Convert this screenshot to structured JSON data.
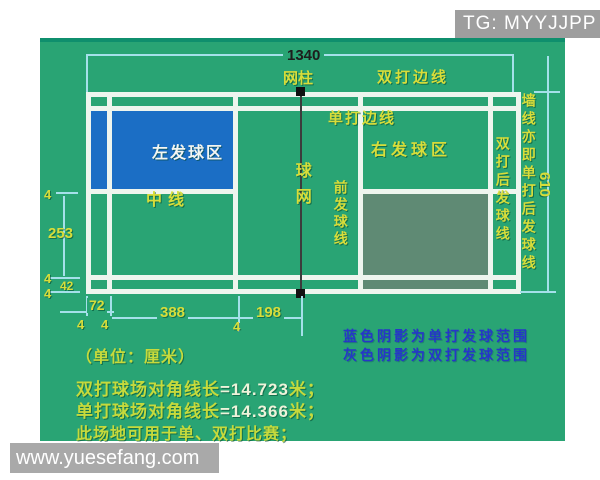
{
  "header": {
    "tg_badge": "TG: MYYJJPP"
  },
  "footer": {
    "watermark": "www.yuesefang.com"
  },
  "colors": {
    "court_green": "#29a474",
    "singles_service_blue": "#1b6ec5",
    "doubles_service_gray": "#5f8a74",
    "court_line_white": "#eef5ee",
    "dimension_cyan": "#a5e0ea",
    "label_yellow": "#d8dd3a",
    "note_blue": "#2636c8"
  },
  "dim_labels": {
    "length_total": "1340",
    "width_total": "610",
    "center_to_singles": "253",
    "sideline_gap": "42",
    "back_to_doubles_service": "72",
    "doubles_service_to_front": "388",
    "front_to_net": "198",
    "line_width": "4"
  },
  "court_labels": {
    "net_post": "网柱",
    "doubles_sideline": "双打边线",
    "singles_sideline": "单打边线",
    "left_service_area": "左发球区",
    "right_service_area": "右发球区",
    "center_line": "中线",
    "net": "球网",
    "front_service_line": "前发球线",
    "doubles_back_service_line": "双打后发球线",
    "wall_line": "墙线亦即单打后发球线"
  },
  "notes": {
    "blue_note": "蓝色阴影为单打发球范围",
    "gray_note": "灰色阴影为双打发球范围",
    "unit": "（单位：厘米）",
    "doubles_diag_prefix": "双打球场对角线长",
    "doubles_diag_value": "=14.723",
    "doubles_diag_suffix": "米；",
    "singles_diag_prefix": "单打球场对角线长",
    "singles_diag_value": "=14.366",
    "singles_diag_suffix": "米；",
    "usage": "此场地可用于单、双打比赛；"
  }
}
